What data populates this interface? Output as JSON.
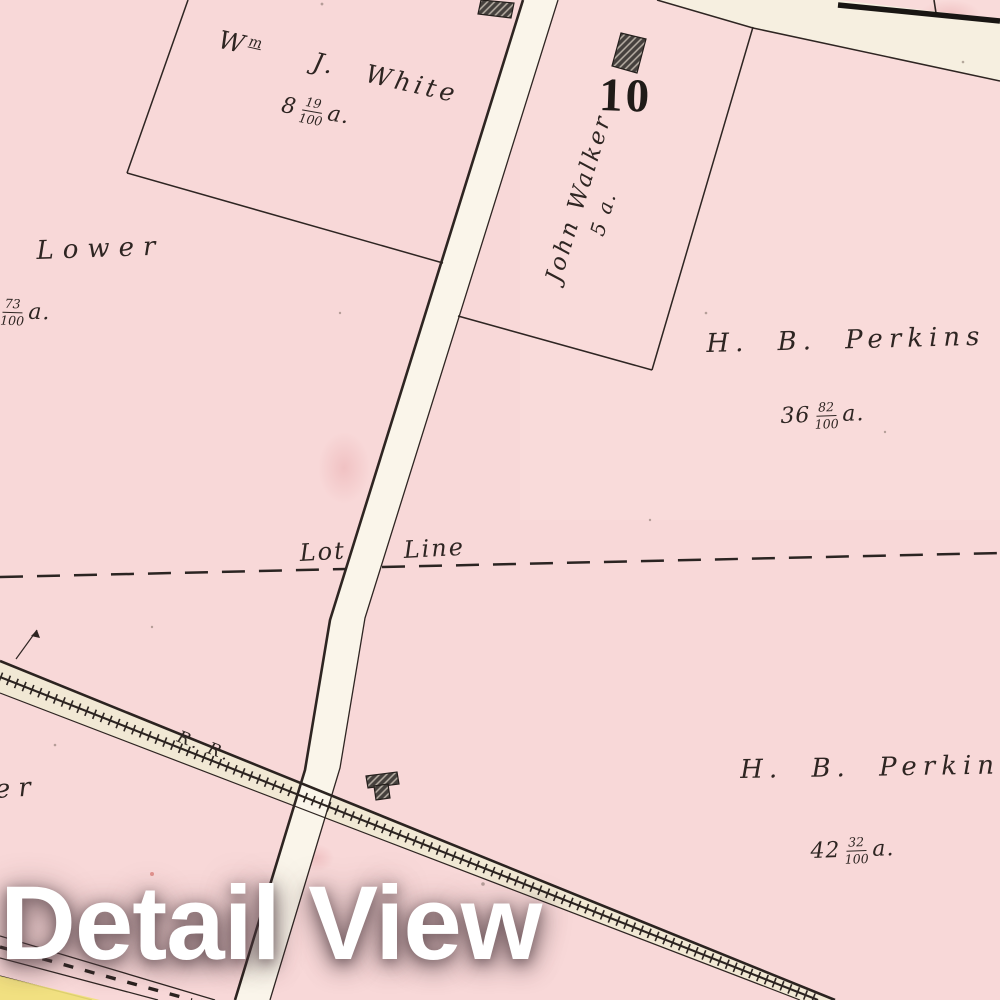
{
  "overlay": {
    "title": "Detail View"
  },
  "map": {
    "district_number": "10",
    "parcels": [
      {
        "name": "wm-j-white",
        "owner_prefix": "W",
        "owner_prefix_sup": "m",
        "owner_rest": "J. White",
        "acre_whole": "8",
        "acre_num": "19",
        "acre_den": "100",
        "acre_unit": "a."
      },
      {
        "name": "lower",
        "owner": "Lower",
        "acre_whole": "8",
        "acre_num": "73",
        "acre_den": "100",
        "acre_unit": "a."
      },
      {
        "name": "john-walker",
        "owner": "John Walker",
        "acreage": "5 a."
      },
      {
        "name": "hb-perkins-north",
        "owner": "H. B. Perkins",
        "acre_whole": "36",
        "acre_num": "82",
        "acre_den": "100",
        "acre_unit": "a."
      },
      {
        "name": "hb-perkins-south",
        "owner": "H. B. Perkins",
        "acre_whole": "42",
        "acre_num": "32",
        "acre_den": "100",
        "acre_unit": "a."
      },
      {
        "name": "lower-west-partial",
        "owner_visible": "er"
      }
    ],
    "annotations": {
      "lot_line_left": "Lot",
      "lot_line_right": "Line",
      "railroad_label": "R. R."
    },
    "colors": {
      "parcel_pink": "#f8d8d8",
      "road_cream": "#faf5ea",
      "railroad_cream": "#f1e8d4",
      "boundary_line": "#2e2522",
      "heavy_line": "#191513",
      "building_fill": "#45403d",
      "yellow_parcel": "#efe178",
      "title_white": "#ffffff"
    }
  }
}
